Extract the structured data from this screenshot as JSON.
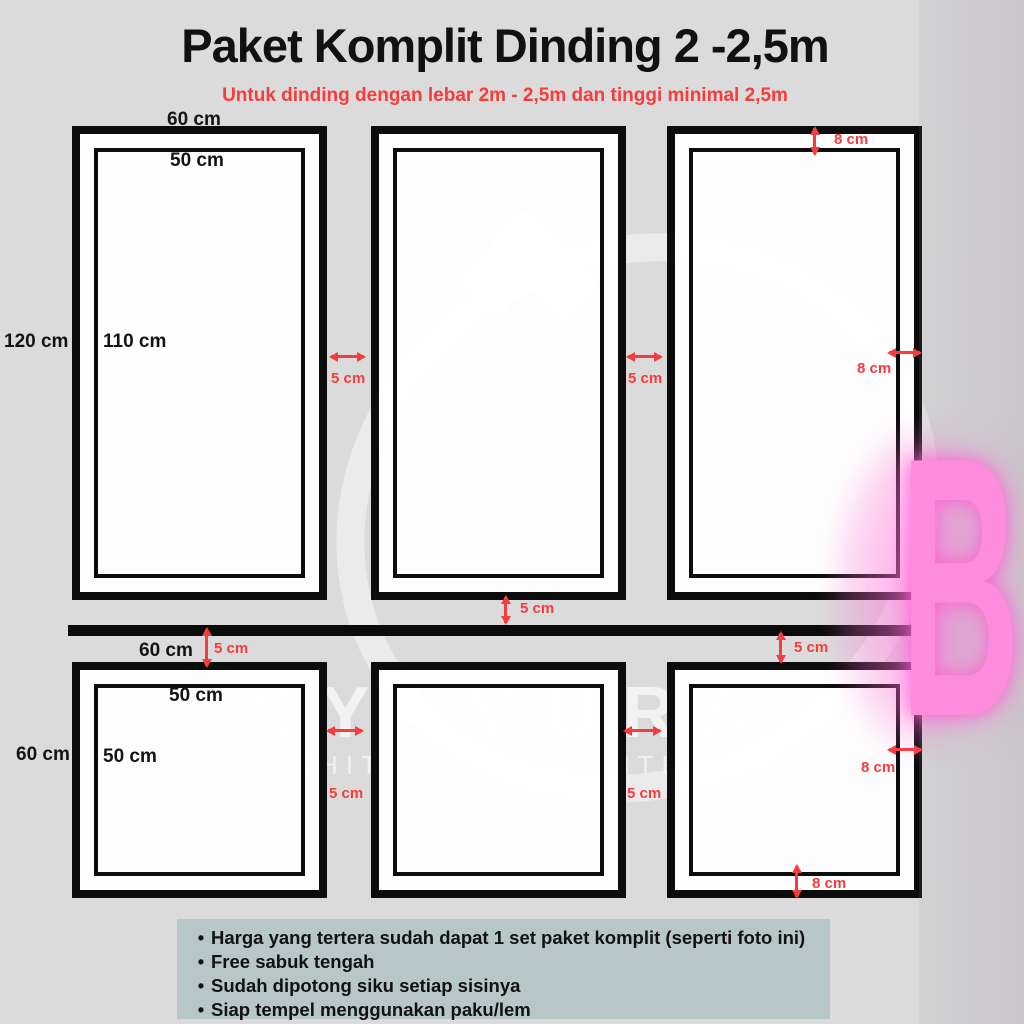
{
  "poster": {
    "title": "Paket Komplit Dinding 2 -2,5m",
    "subtitle": "Untuk dinding dengan lebar 2m - 2,5m dan tinggi minimal 2,5m"
  },
  "colors": {
    "background": "#dbdbdb",
    "frame_border": "#0c0c0c",
    "accent_red": "#f63c3c",
    "notes_box": "#b7c7c8",
    "corner_letter_pink": "#fd8cdc"
  },
  "dimension_labels": {
    "top_row": {
      "outer_width": "60 cm",
      "inner_width": "50 cm",
      "outer_height": "120 cm",
      "inner_height": "110 cm",
      "gap_left": "5 cm",
      "gap_right": "5 cm",
      "right_frame_top_margin": "8 cm",
      "right_frame_side_margin": "8 cm"
    },
    "belt": {
      "gap_above": "5 cm",
      "gap_below_left": "5 cm",
      "gap_below_right": "5 cm"
    },
    "bottom_row": {
      "outer_width": "60 cm",
      "inner_width": "50 cm",
      "outer_height": "60 cm",
      "inner_height": "50 cm",
      "gap_left": "5 cm",
      "gap_right": "5 cm",
      "right_frame_side_margin": "8 cm",
      "right_frame_bottom_margin": "8 cm"
    }
  },
  "notes": {
    "bullet": "•",
    "items": [
      "Harga yang tertera sudah dapat 1 set paket komplit (seperti foto ini)",
      "Free sabuk tengah",
      "Sudah dipotong siku setiap sisinya",
      "Siap tempel menggunakan paku/lem"
    ]
  },
  "watermark": {
    "brand": "SYAMURA",
    "tagline": "ARCHITECTURE & INTERIOR",
    "corner_letter": "B"
  }
}
